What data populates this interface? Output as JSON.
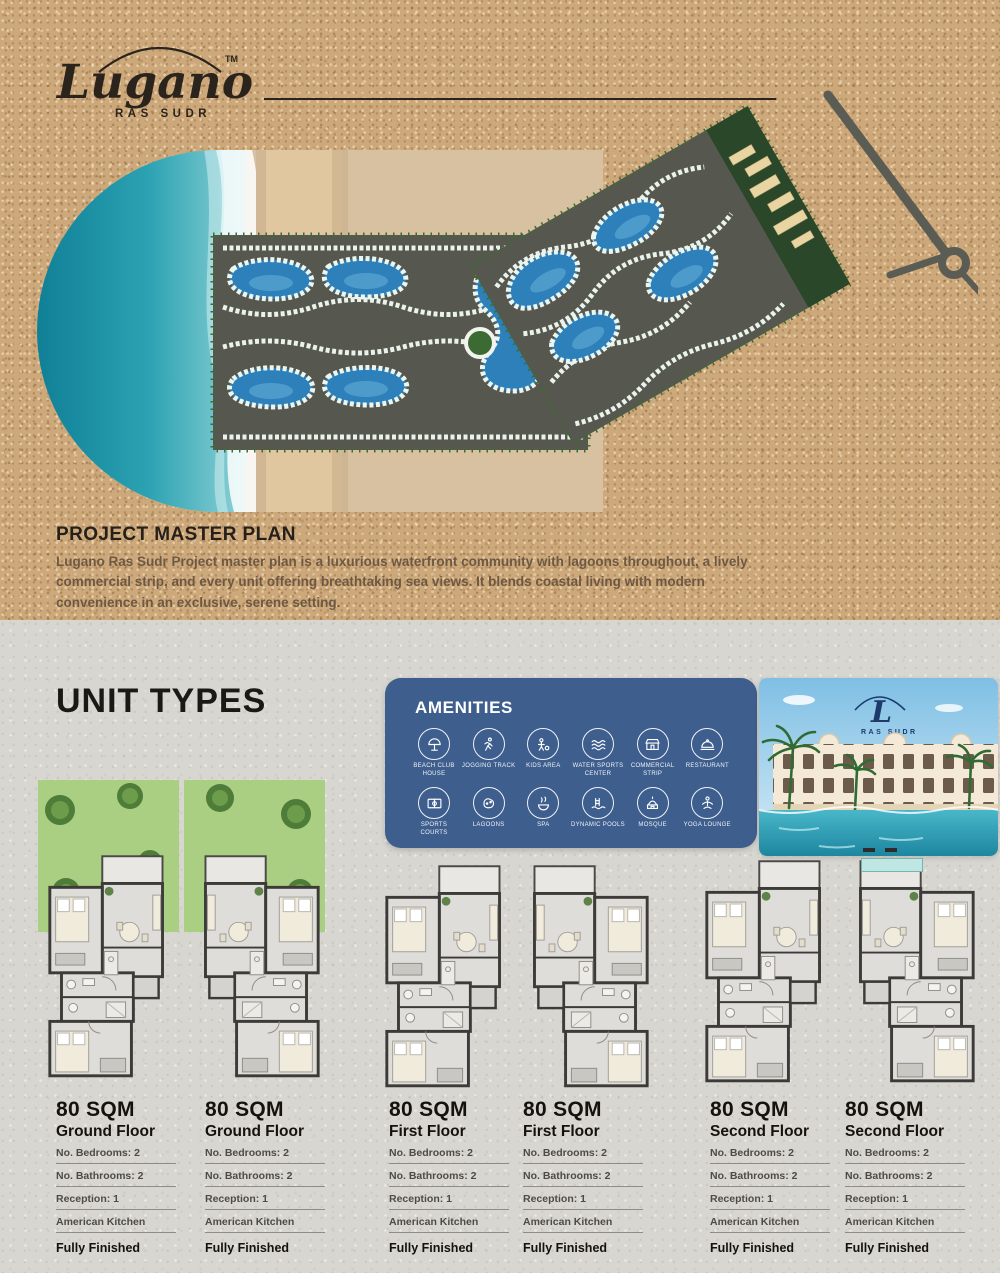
{
  "brand": {
    "name": "Lugano",
    "sub": "RAS SUDR",
    "tm": "TM"
  },
  "master_plan": {
    "title": "PROJECT MASTER PLAN",
    "description": "Lugano Ras Sudr Project master plan is a luxurious waterfront community with lagoons throughout, a lively commercial strip, and every unit offering breathtaking sea views. It blends coastal living with modern convenience in an exclusive, serene setting."
  },
  "unit_types_title": "UNIT TYPES",
  "amenities": {
    "title": "AMENITIES",
    "items": [
      {
        "label": "Beach Club House",
        "icon": "beach-club-icon"
      },
      {
        "label": "Jogging Track",
        "icon": "jogging-track-icon"
      },
      {
        "label": "Kids Area",
        "icon": "kids-area-icon"
      },
      {
        "label": "Water Sports Center",
        "icon": "water-sports-icon"
      },
      {
        "label": "Commercial Strip",
        "icon": "commercial-strip-icon"
      },
      {
        "label": "Restaurant",
        "icon": "restaurant-icon"
      },
      {
        "label": "Sports Courts",
        "icon": "sports-courts-icon"
      },
      {
        "label": "Lagoons",
        "icon": "lagoons-icon"
      },
      {
        "label": "Spa",
        "icon": "spa-icon"
      },
      {
        "label": "Dynamic Pools",
        "icon": "dynamic-pools-icon"
      },
      {
        "label": "Mosque",
        "icon": "mosque-icon"
      },
      {
        "label": "Yoga Lounge",
        "icon": "yoga-lounge-icon"
      }
    ]
  },
  "photo": {
    "monogram": "L",
    "caption": "RAS SUDR"
  },
  "units": [
    {
      "area": "80 SQM",
      "floor": "Ground Floor",
      "bedrooms": "No. Bedrooms:  2",
      "bathrooms": "No. Bathrooms: 2",
      "reception": "Reception: 1",
      "kitchen": "American Kitchen",
      "finish": "Fully Finished"
    },
    {
      "area": "80 SQM",
      "floor": "Ground Floor",
      "bedrooms": "No. Bedrooms:  2",
      "bathrooms": "No. Bathrooms: 2",
      "reception": "Reception: 1",
      "kitchen": "American Kitchen",
      "finish": "Fully Finished"
    },
    {
      "area": "80 SQM",
      "floor": "First Floor",
      "bedrooms": "No. Bedrooms:  2",
      "bathrooms": "No. Bathrooms: 2",
      "reception": "Reception: 1",
      "kitchen": "American Kitchen",
      "finish": "Fully Finished"
    },
    {
      "area": "80 SQM",
      "floor": "First Floor",
      "bedrooms": "No. Bedrooms:  2",
      "bathrooms": "No. Bathrooms: 2",
      "reception": "Reception: 1",
      "kitchen": "American Kitchen",
      "finish": "Fully Finished"
    },
    {
      "area": "80 SQM",
      "floor": "Second Floor",
      "bedrooms": "No. Bedrooms:  2",
      "bathrooms": "No. Bathrooms: 2",
      "reception": "Reception: 1",
      "kitchen": "American Kitchen",
      "finish": "Fully Finished"
    },
    {
      "area": "80 SQM",
      "floor": "Second Floor",
      "bedrooms": "No. Bedrooms:  2",
      "bathrooms": "No. Bathrooms: 2",
      "reception": "Reception: 1",
      "kitchen": "American Kitchen",
      "finish": "Fully Finished"
    }
  ],
  "colors": {
    "sand": "#cda87b",
    "panel_blue": "#3e5e8e",
    "section_gray": "#d8d6d0",
    "lagoon_blue": "#2e80ba",
    "text_dark": "#26201a"
  }
}
